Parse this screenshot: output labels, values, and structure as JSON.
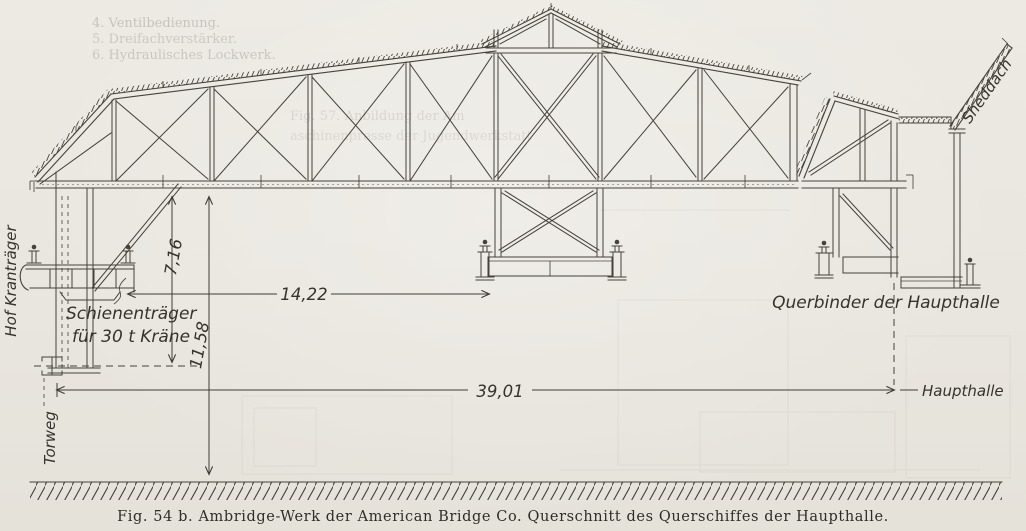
{
  "labels": {
    "hof_krantraeger": "Hof Kranträger",
    "schienentraeger_1": "Schienenträger",
    "schienentraeger_2": "für 30 t Kräne",
    "torweg": "Torweg",
    "querbinder": "Querbinder der Haupthalle",
    "haupthalle": "Haupthalle",
    "sheddach": "Sheddach"
  },
  "dimensions": {
    "crane_rail_to_chord": "7,16",
    "floor_to_chord": "11,58",
    "crane_span": "14,22",
    "total_span": "39,01"
  },
  "caption": "Fig. 54 b.  Ambridge-Werk der American Bridge Co.  Querschnitt des Querschiffes der Haupthalle.",
  "bleedthrough": {
    "l1": "4. Ventilbedienung.",
    "l2": "5. Dreifachverstärker.",
    "l3": "6. Hydraulisches Lockwerk.",
    "l4": "Fig. 57.  Anbildung der Am",
    "l5": "aschinenpresse der Jugendwerkstatt"
  }
}
